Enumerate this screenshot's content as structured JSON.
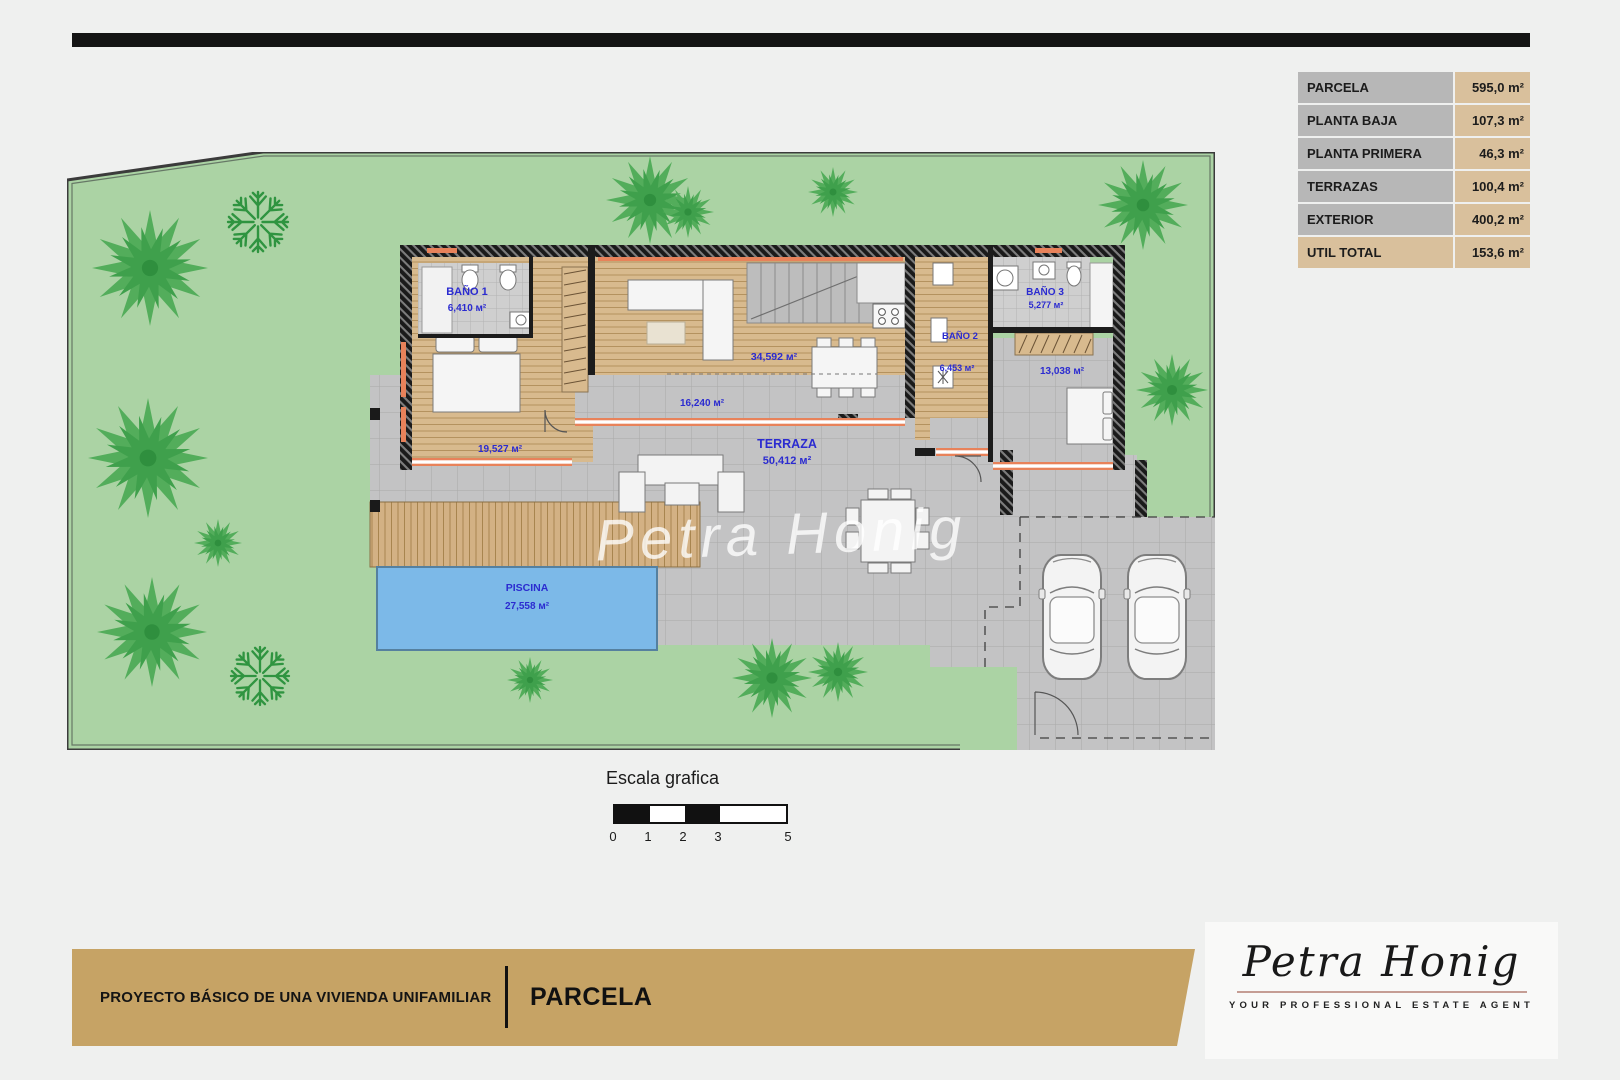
{
  "areas_table": {
    "rows": [
      {
        "label": "PARCELA",
        "value": "595,0 m²"
      },
      {
        "label": "PLANTA BAJA",
        "value": "107,3 m²"
      },
      {
        "label": "PLANTA PRIMERA",
        "value": "46,3 m²"
      },
      {
        "label": "TERRAZAS",
        "value": "100,4 m²"
      },
      {
        "label": "EXTERIOR",
        "value": "400,2 m²"
      },
      {
        "label": "UTIL TOTAL",
        "value": "153,6 m²"
      }
    ]
  },
  "plan": {
    "rooms": {
      "bano1": {
        "name": "BAÑO 1",
        "area": "6,410 м²"
      },
      "bedroom1": {
        "area": "19,527 м²"
      },
      "living": {
        "area": "34,592 м²"
      },
      "hall": {
        "area": "16,240 м²"
      },
      "bano2": {
        "name": "BAÑO 2",
        "area": "6,453 м²"
      },
      "bano3": {
        "name": "BAÑO 3",
        "area": "5,277 м²"
      },
      "bedroom2": {
        "area": "13,038 м²"
      },
      "terrace": {
        "name": "TERRAZA",
        "area": "50,412 м²"
      },
      "pool": {
        "name": "PISCINA",
        "area": "27,558 м²"
      }
    },
    "watermark": "Petra Honig"
  },
  "scale_bar": {
    "title": "Escala grafica",
    "ticks": [
      "0",
      "1",
      "2",
      "3",
      "5"
    ]
  },
  "footer": {
    "project_title": "PROYECTO BÁSICO DE UNA VIVIENDA UNIFAMILIAR",
    "sheet_title": "PARCELA"
  },
  "logo": {
    "name": "Petra Honig",
    "tagline": "YOUR PROFESSIONAL ESTATE AGENT"
  },
  "colors": {
    "gold": "#c6a365",
    "table_label_bg": "#b7b7b7",
    "table_value_bg": "#d9c09c",
    "plot_green": "#abd3a4",
    "pool_blue": "#7cb9e8",
    "label_blue": "#2b2bd0",
    "window_orange": "#e8825a"
  }
}
